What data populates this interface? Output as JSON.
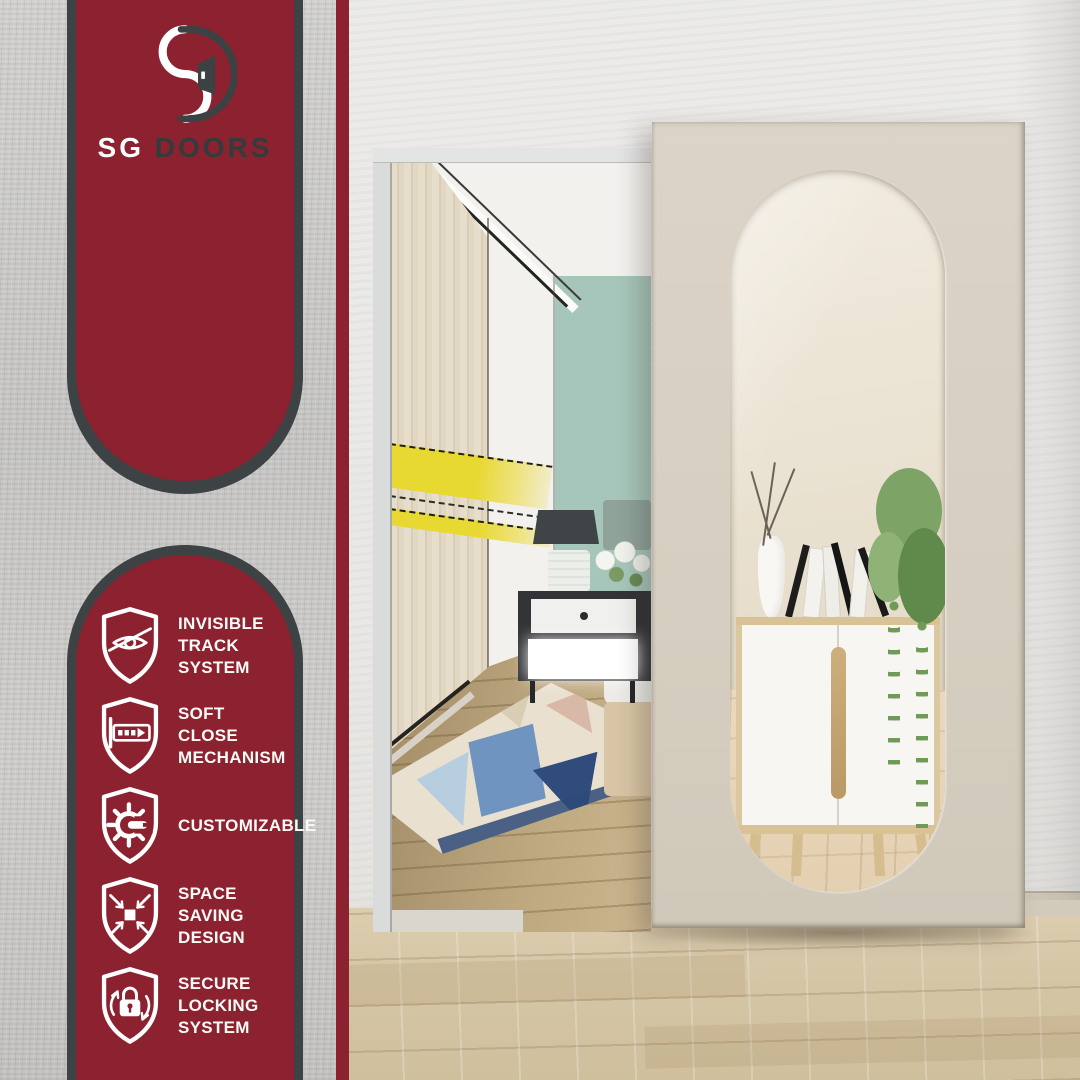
{
  "brand": {
    "primary": "SG",
    "secondary": "DOORS"
  },
  "features": [
    {
      "id": "invisible-track",
      "icon": "eye-slash-shield-icon",
      "lines": [
        "INVISIBLE",
        "TRACK",
        "SYSTEM"
      ]
    },
    {
      "id": "soft-close",
      "icon": "soft-close-rail-shield-icon",
      "lines": [
        "SOFT",
        "CLOSE",
        "MECHANISM"
      ]
    },
    {
      "id": "customizable",
      "icon": "gear-wrench-shield-icon",
      "lines": [
        "CUSTOMIZABLE"
      ]
    },
    {
      "id": "space-saving",
      "icon": "compress-arrows-shield-icon",
      "lines": [
        "SPACE",
        "SAVING",
        "DESIGN"
      ]
    },
    {
      "id": "secure-locking",
      "icon": "lock-rotate-shield-icon",
      "lines": [
        "SECURE",
        "LOCKING",
        "SYSTEM"
      ]
    }
  ],
  "colors": {
    "maroon": "#8C2130",
    "charcoal_outline": "#3D4344",
    "panel_text": "#FFFFFF",
    "gray_concrete_wall": "#CBCAC8",
    "door_panel": "#D8D0C2",
    "mirror_cream": "#EDE5D7",
    "teal_accent_wall": "#A7C6BB",
    "yellow_stripe": "#E8D832",
    "hallway_floor_wood": "#D5C6A8",
    "bedroom_floor_wood": "#AE9671"
  }
}
